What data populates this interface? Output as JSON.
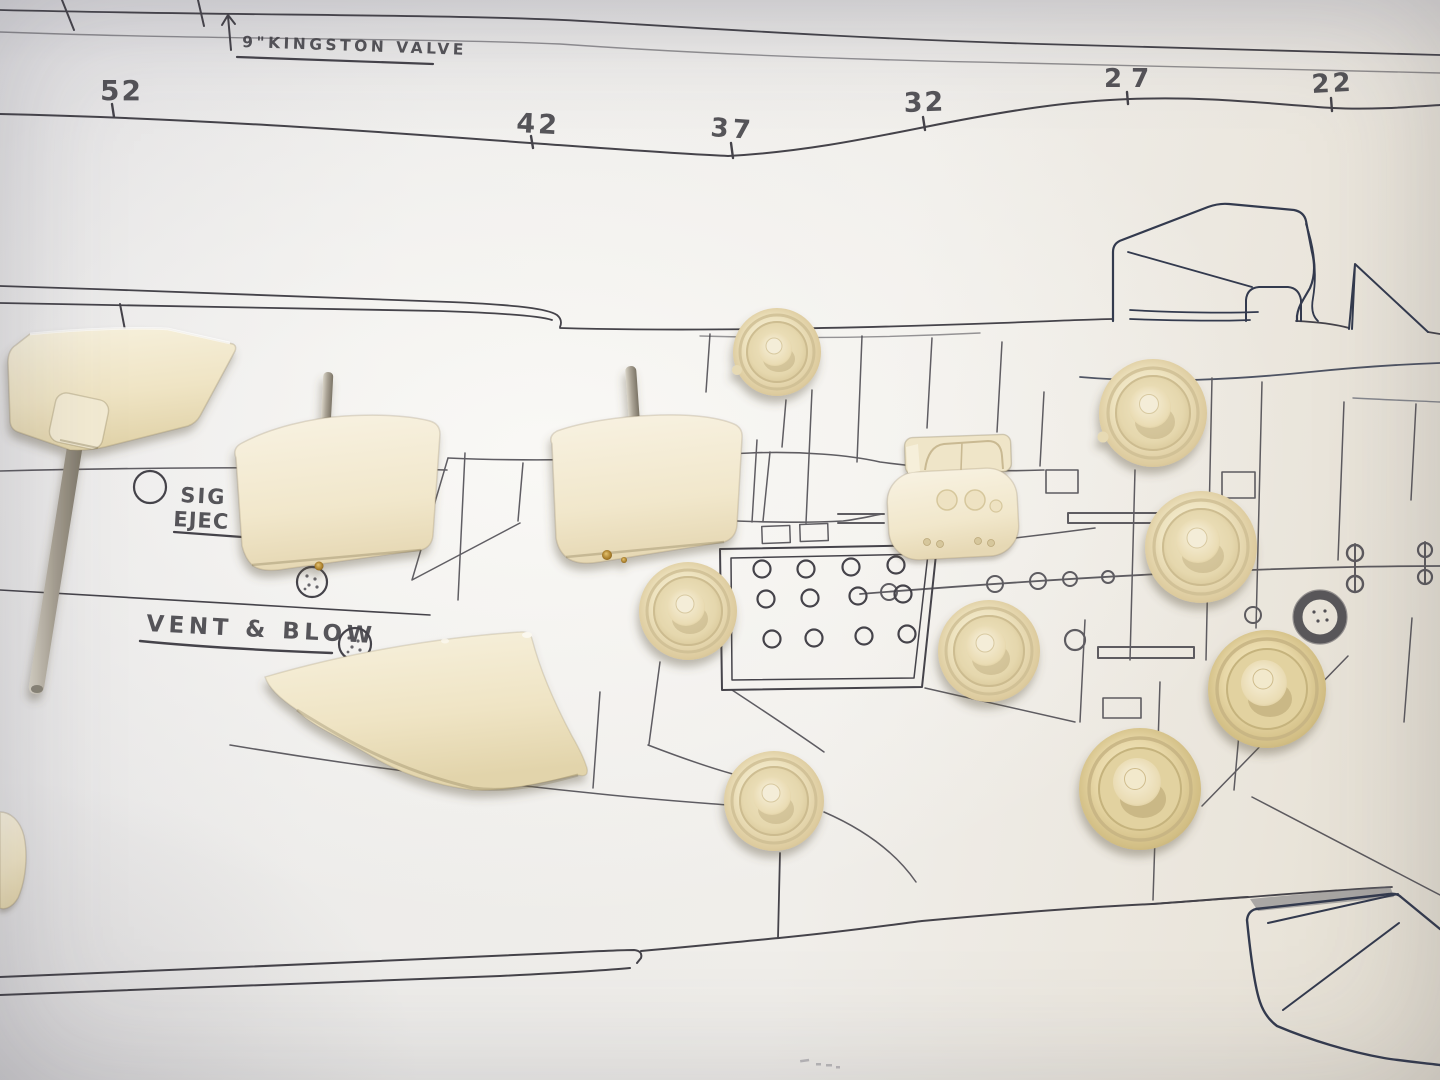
{
  "photo": {
    "subject": "Cream resin model submarine fittings laid over a hand-drawn submarine plan",
    "plan": {
      "stations": [
        "52",
        "42",
        "37",
        "32",
        "27",
        "22"
      ],
      "labels": {
        "kingston_valve": "9\"KINGSTON  VALVE",
        "signal_line1": "SIG",
        "signal_line2": "EJEC",
        "vent_blow": "VENT & BLOW"
      }
    },
    "parts": {
      "wheels": "8 resin wheels with hub bosses",
      "dive_planes": "2 rounded dive planes with steel pins",
      "rudder": "fin blade on long steel shaft",
      "curved_fin": "curved fin blade",
      "bracket": "saddle bracket casting",
      "edge_fragment": "part fragment at left edge"
    },
    "colors": {
      "paper": "#eeedeb",
      "pencil_ink": "#45434a",
      "blue_ink": "#333a4e",
      "resin_cream": "#eee3c0",
      "resin_yellow": "#e7d7a6",
      "metal_gray": "#a29b8c",
      "brass": "#b08a3e"
    }
  }
}
